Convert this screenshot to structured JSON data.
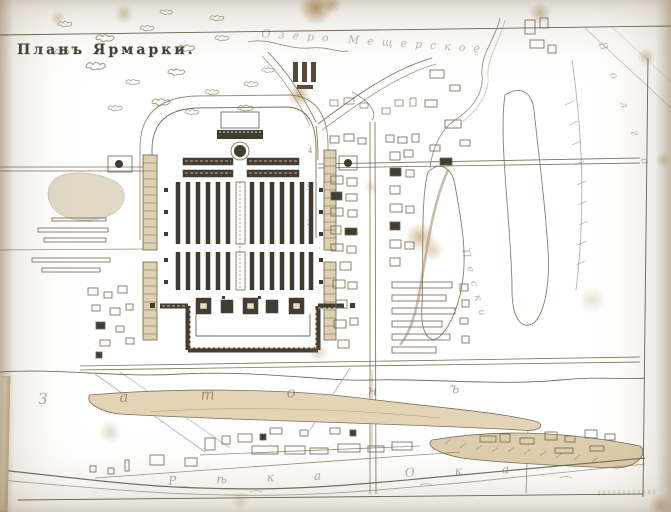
{
  "title": "Планъ Ярмарки.",
  "labels": {
    "lake": "Озеро Мещерское",
    "backwater": "Затонъ",
    "river": "Рѣка Ока",
    "sands": "Пески",
    "volga_bank": "Волга"
  },
  "annotations": {
    "n1": "4",
    "n2": "3",
    "n3": "2"
  },
  "colors": {
    "paper": "#e9dcbf",
    "ink": "#5c5347",
    "ink_faint": "#a3967e",
    "ink_dark": "#433c33",
    "stain": "#a97f3f"
  }
}
